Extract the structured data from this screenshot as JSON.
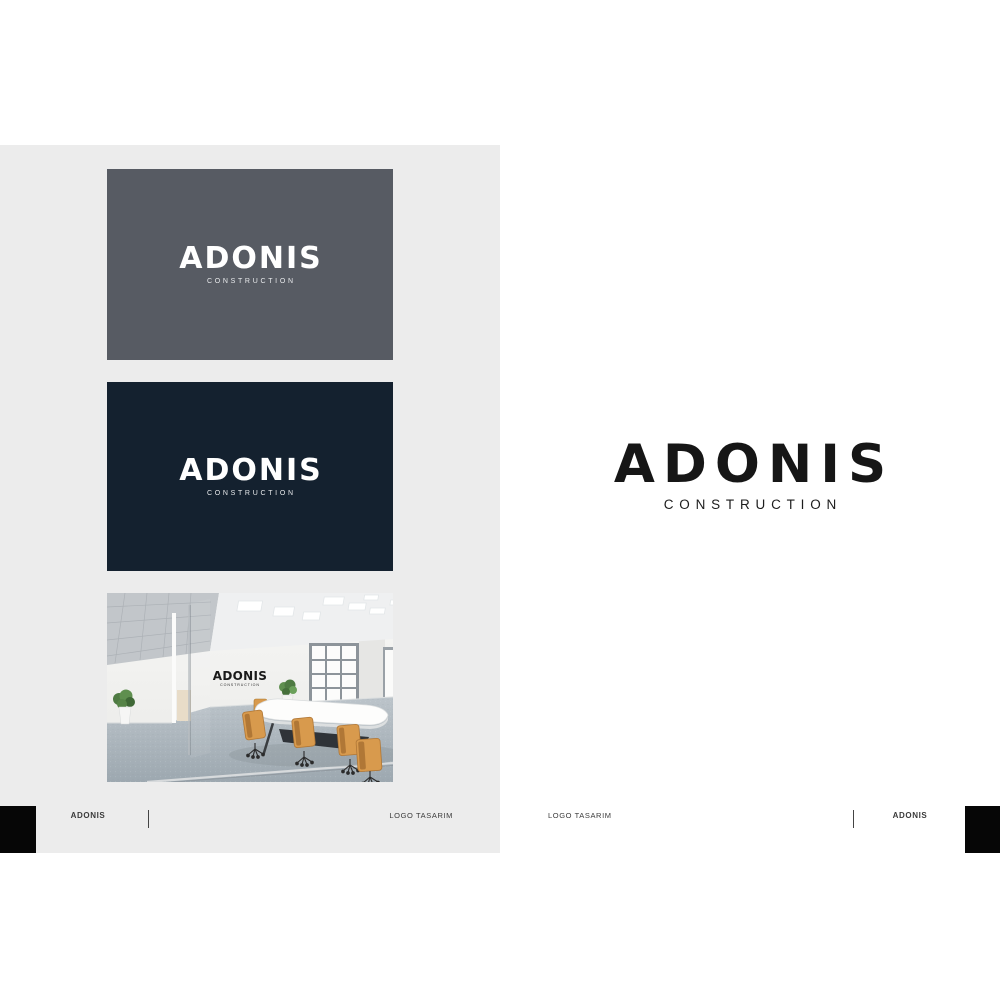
{
  "brand": {
    "name": "ADONIS",
    "tagline": "CONSTRUCTION"
  },
  "cards": {
    "slate": {
      "background": "#575b63"
    },
    "navy": {
      "background": "#14212f"
    }
  },
  "footer": {
    "left_brand": "ADONIS",
    "left_caption": "LOGO TASARIM",
    "right_caption": "LOGO TASARIM",
    "right_brand": "ADONIS"
  },
  "colors": {
    "canvas": "#ececec",
    "card_slate": "#575b63",
    "card_navy": "#14212f",
    "logo_ink": "#161616",
    "logo_light": "#ffffff",
    "footer_text": "#3a3a3a",
    "accent_black": "#060606"
  }
}
